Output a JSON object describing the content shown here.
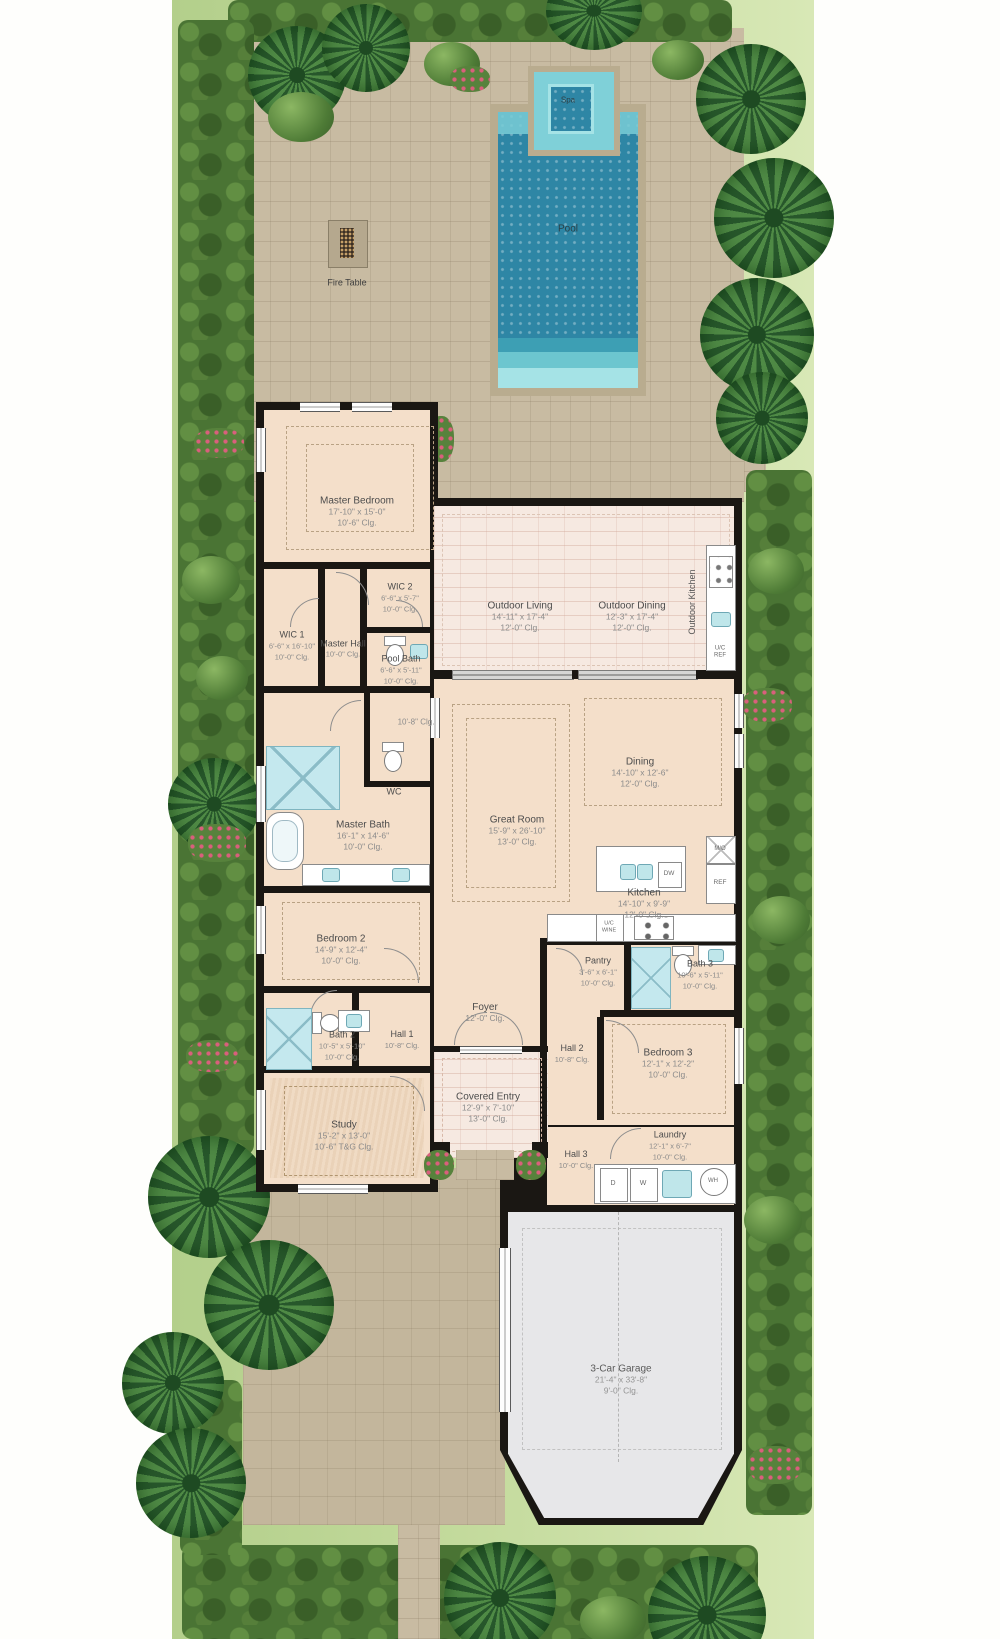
{
  "site": {
    "pool_label": "Pool",
    "spa_label": "Spa",
    "fire_table_label": "Fire Table"
  },
  "rooms": {
    "master_bedroom": {
      "name": "Master Bedroom",
      "dims": "17'-10\" x 15'-0\"",
      "clg": "10'-6\" Clg."
    },
    "wic1": {
      "name": "WIC 1",
      "dims": "6'-6\" x 16'-10\"",
      "clg": "10'-0\" Clg."
    },
    "wic2": {
      "name": "WIC 2",
      "dims": "6'-6\" x 5'-7\"",
      "clg": "10'-0\" Clg."
    },
    "master_hall": {
      "name": "Master Hall",
      "clg": "10'-0\" Clg."
    },
    "pool_bath": {
      "name": "Pool Bath",
      "dims": "6'-6\" x 5'-11\"",
      "clg": "10'-0\" Clg."
    },
    "upper_hall": {
      "clg": "10'-8\" Clg."
    },
    "wc": {
      "name": "WC"
    },
    "outdoor_living": {
      "name": "Outdoor Living",
      "dims": "14'-11\" x 17'-4\"",
      "clg": "12'-0\" Clg."
    },
    "outdoor_dining": {
      "name": "Outdoor Dining",
      "dims": "12'-3\" x 17'-4\"",
      "clg": "12'-0\" Clg."
    },
    "outdoor_kitchen": {
      "name": "Outdoor Kitchen"
    },
    "dining": {
      "name": "Dining",
      "dims": "14'-10\" x 12'-6\"",
      "clg": "12'-0\" Clg."
    },
    "great_room": {
      "name": "Great Room",
      "dims": "15'-9\" x 26'-10\"",
      "clg": "13'-0\" Clg."
    },
    "kitchen": {
      "name": "Kitchen",
      "dims": "14'-10\" x 9'-9\"",
      "clg": "12'-0\" Clg."
    },
    "master_bath": {
      "name": "Master Bath",
      "dims": "16'-1\" x 14'-6\"",
      "clg": "10'-0\" Clg."
    },
    "bedroom2": {
      "name": "Bedroom 2",
      "dims": "14'-9\" x 12'-4\"",
      "clg": "10'-0\" Clg."
    },
    "pantry": {
      "name": "Pantry",
      "dims": "3'-6\" x 6'-1\"",
      "clg": "10'-0\" Clg."
    },
    "bath3": {
      "name": "Bath 3",
      "dims": "10'-6\" x 5'-11\"",
      "clg": "10'-0\" Clg."
    },
    "bath2": {
      "name": "Bath 2",
      "dims": "10'-5\" x 5'-10\"",
      "clg": "10'-0\" Clg."
    },
    "hall1": {
      "name": "Hall 1",
      "clg": "10'-8\" Clg."
    },
    "foyer": {
      "name": "Foyer",
      "clg": "12'-0\" Clg."
    },
    "hall2": {
      "name": "Hall 2",
      "clg": "10'-8\" Clg."
    },
    "bedroom3": {
      "name": "Bedroom 3",
      "dims": "12'-1\" x 12'-2\"",
      "clg": "10'-0\" Clg."
    },
    "study": {
      "name": "Study",
      "dims": "15'-2\" x 13'-0\"",
      "clg": "10'-6\" T&G Clg."
    },
    "covered_entry": {
      "name": "Covered Entry",
      "dims": "12'-9\" x 7'-10\"",
      "clg": "13'-0\" Clg."
    },
    "hall3": {
      "name": "Hall 3",
      "clg": "10'-0\" Clg."
    },
    "laundry": {
      "name": "Laundry",
      "dims": "12'-1\" x 6'-7\"",
      "clg": "10'-0\" Clg."
    },
    "garage": {
      "name": "3-Car Garage",
      "dims": "21'-4\" x 33'-8\"",
      "clg": "9'-0\" Clg."
    }
  },
  "fixtures": {
    "microwave_oven": "M/O",
    "refrigerator": "REF",
    "dishwasher": "DW",
    "uc_wine_line1": "U/C",
    "uc_wine_line2": "WINE",
    "uc_ref_line1": "U/C",
    "uc_ref_line2": "REF",
    "dryer": "D",
    "washer": "W",
    "water_heater": "WH"
  },
  "colors": {
    "pool_water": "#2e86a5",
    "walls": "#1a1713",
    "interior_floor": "#f4dfca",
    "outdoor_floor": "#f6e9e1",
    "garage_floor": "#e7e7e9",
    "paver_deck": "#c8bba2",
    "grass": "#c3da9c",
    "hedge": "#4a7434"
  }
}
